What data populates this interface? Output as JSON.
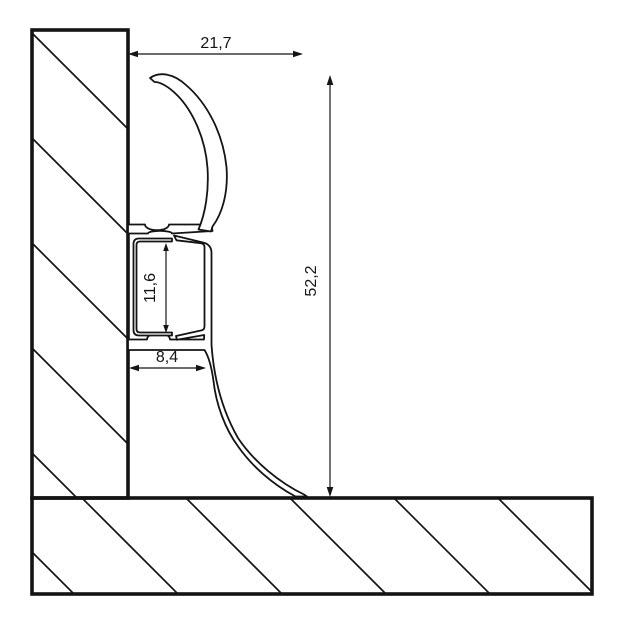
{
  "diagram": {
    "kind": "skirting-board-profile-cross-section",
    "dimensions": {
      "top_width": "21,7",
      "total_height": "52,2",
      "channel_height": "11,6",
      "base_depth": "8,4"
    },
    "colors": {
      "line": "#141414",
      "background": "#ffffff"
    }
  }
}
